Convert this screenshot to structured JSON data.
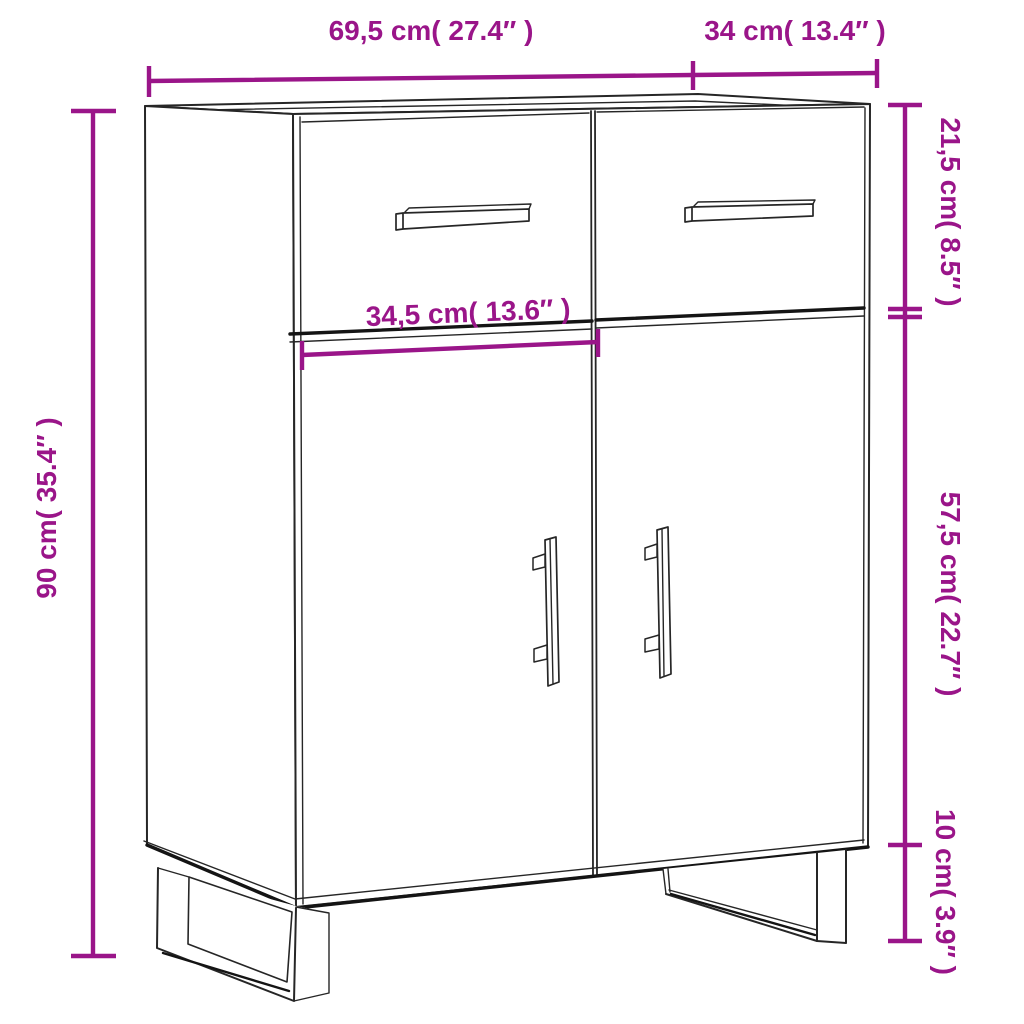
{
  "diagram": {
    "accent_color": "#9A1589",
    "line_color": "#262626",
    "labels": {
      "width": "69,5 cm( 27.4″ )",
      "depth": "34 cm( 13.4″ )",
      "height": "90 cm( 35.4″ )",
      "drawer_section_height": "21,5 cm( 8.5″ )",
      "door_section_height": "57,5 cm( 22.7″ )",
      "leg_height": "10 cm( 3.9″ )",
      "door_width": "34,5 cm( 13.6″ )"
    }
  }
}
